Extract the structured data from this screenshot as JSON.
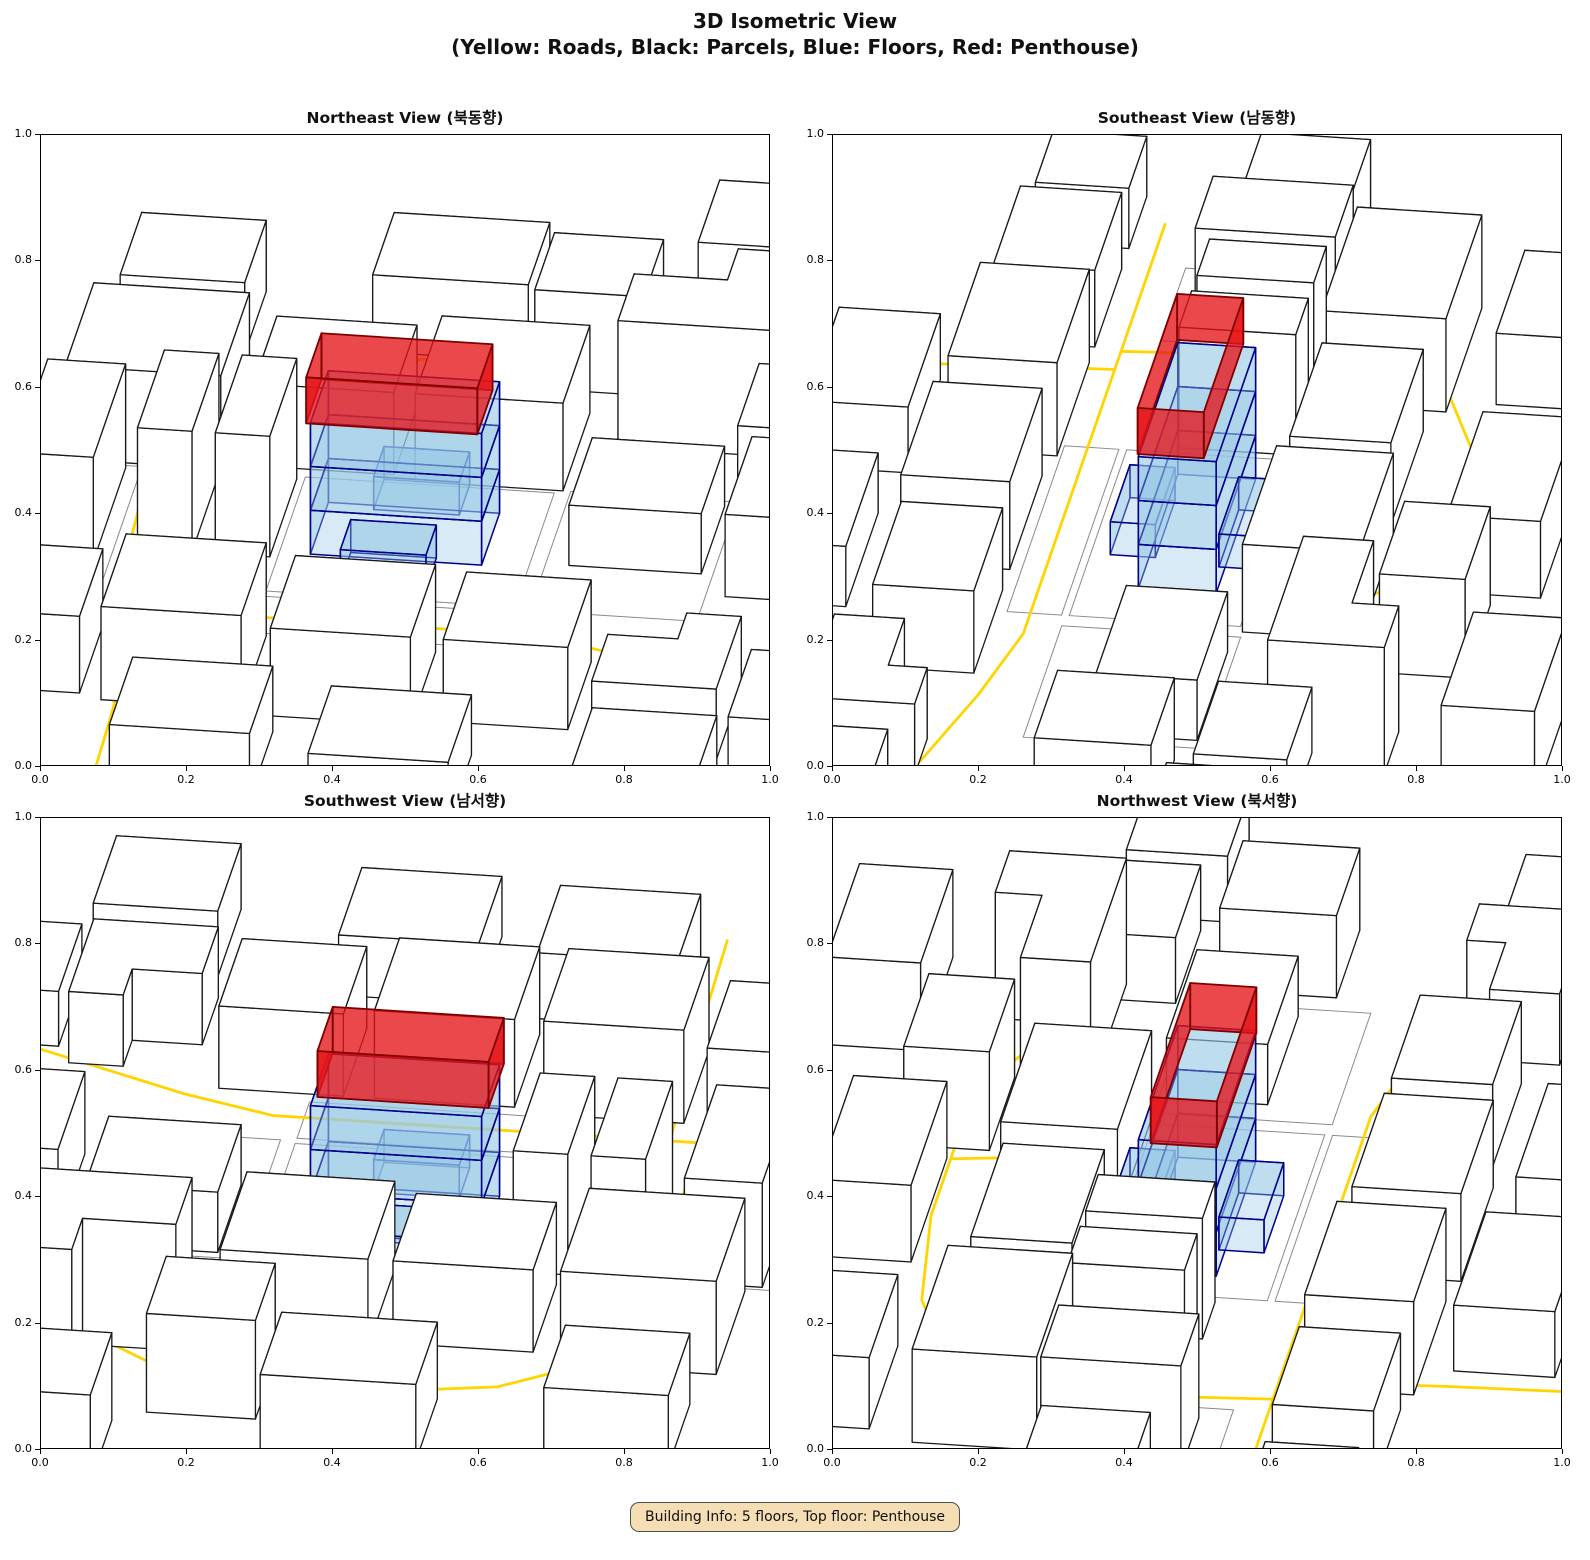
{
  "figure": {
    "title_line1": "3D Isometric View",
    "title_line2": "(Yellow: Roads, Black: Parcels, Blue: Floors, Red: Penthouse)"
  },
  "views": [
    {
      "id": "northeast",
      "title": "Northeast View (북동향)",
      "rotation": 0
    },
    {
      "id": "southeast",
      "title": "Southeast View (남동향)",
      "rotation": 90
    },
    {
      "id": "southwest",
      "title": "Southwest View (남서향)",
      "rotation": 180
    },
    {
      "id": "northwest",
      "title": "Northwest View (북서향)",
      "rotation": 270
    }
  ],
  "axes": {
    "x_ticks": [
      "0.0",
      "0.2",
      "0.4",
      "0.6",
      "0.8",
      "1.0"
    ],
    "y_ticks": [
      "0.0",
      "0.2",
      "0.4",
      "0.6",
      "0.8",
      "1.0"
    ],
    "x_range": [
      0.0,
      1.0
    ],
    "y_range": [
      0.0,
      1.0
    ]
  },
  "colors": {
    "road": "#FFD400",
    "parcel_fill": "#FFFFFF",
    "parcel_edge": "#1a1a1a",
    "floor_fill": "rgba(150,200,230,0.38)",
    "floor_edge": "#00008B",
    "penthouse_fill": "rgba(230,20,25,0.78)",
    "penthouse_edge": "#7f0000",
    "lot_line": "#8a8a8a",
    "info_fill": "#F5DEB3",
    "info_border": "#4d4d4d"
  },
  "info_box": {
    "text": "Building Info: 5 floors, Top floor: Penthouse"
  },
  "building": {
    "floors_count": 5,
    "top_floor": "Penthouse",
    "floors": [
      {
        "x0": -1.1,
        "y0": -0.5,
        "x1": 1.1,
        "y1": 0.5,
        "z0": 0.0,
        "z1": 0.4
      },
      {
        "x0": -1.1,
        "y0": -0.5,
        "x1": 1.1,
        "y1": 0.5,
        "z0": 0.4,
        "z1": 0.8
      },
      {
        "x0": -1.1,
        "y0": -0.5,
        "x1": 1.1,
        "y1": 0.5,
        "z0": 0.8,
        "z1": 1.2
      }
    ],
    "annexes": [
      {
        "x0": -0.6,
        "y0": -1.0,
        "x1": 0.5,
        "y1": -0.42,
        "z0": 0.0,
        "z1": 0.3
      },
      {
        "x0": -0.5,
        "y0": 0.42,
        "x1": 0.6,
        "y1": 1.0,
        "z0": 0.0,
        "z1": 0.3
      }
    ],
    "penthouse": {
      "x0": -1.15,
      "y0": -0.52,
      "x1": 1.05,
      "y1": 0.33,
      "z0": 1.2,
      "z1": 1.62
    }
  },
  "scene": {
    "parcels": [
      {
        "pts": [
          [
            -4.6,
            1.0
          ],
          [
            -2.6,
            1.0
          ],
          [
            -2.6,
            2.6
          ],
          [
            -4.6,
            2.6
          ]
        ],
        "h": 0.85
      },
      {
        "pts": [
          [
            -2.2,
            1.1
          ],
          [
            -0.4,
            1.1
          ],
          [
            -0.4,
            2.4
          ],
          [
            -2.2,
            2.4
          ]
        ],
        "h": 0.75
      },
      {
        "pts": [
          [
            -0.1,
            1.0
          ],
          [
            1.8,
            1.0
          ],
          [
            1.8,
            2.5
          ],
          [
            -0.1,
            2.5
          ]
        ],
        "h": 0.8
      },
      {
        "pts": [
          [
            2.3,
            1.9
          ],
          [
            4.3,
            1.9
          ],
          [
            4.3,
            3.4
          ],
          [
            3.5,
            3.4
          ],
          [
            3.5,
            2.8
          ],
          [
            2.3,
            2.8
          ]
        ],
        "h": 1.15
      },
      {
        "pts": [
          [
            4.0,
            1.2
          ],
          [
            5.4,
            1.2
          ],
          [
            5.4,
            2.4
          ],
          [
            4.0,
            2.4
          ]
        ],
        "h": 0.6
      },
      {
        "pts": [
          [
            1.0,
            2.9
          ],
          [
            2.4,
            2.9
          ],
          [
            2.4,
            4.0
          ],
          [
            1.0,
            4.0
          ]
        ],
        "h": 0.9
      },
      {
        "pts": [
          [
            -1.2,
            3.4
          ],
          [
            0.8,
            3.4
          ],
          [
            0.8,
            4.6
          ],
          [
            -1.2,
            4.6
          ]
        ],
        "h": 0.7
      },
      {
        "pts": [
          [
            -4.8,
            -0.9
          ],
          [
            -3.8,
            -0.9
          ],
          [
            -3.8,
            0.9
          ],
          [
            -4.8,
            0.9
          ]
        ],
        "h": 0.95
      },
      {
        "pts": [
          [
            -3.3,
            -0.6
          ],
          [
            -2.6,
            -0.6
          ],
          [
            -2.6,
            0.9
          ],
          [
            -3.3,
            0.9
          ]
        ],
        "h": 1.1
      },
      {
        "pts": [
          [
            -2.3,
            -0.6
          ],
          [
            -1.6,
            -0.6
          ],
          [
            -1.6,
            0.9
          ],
          [
            -2.3,
            0.9
          ]
        ],
        "h": 1.1
      },
      {
        "pts": [
          [
            2.2,
            -0.4
          ],
          [
            3.9,
            -0.4
          ],
          [
            3.9,
            0.9
          ],
          [
            2.2,
            0.9
          ]
        ],
        "h": 0.55
      },
      {
        "pts": [
          [
            4.3,
            -0.8
          ],
          [
            5.6,
            -0.8
          ],
          [
            5.6,
            0.7
          ],
          [
            4.3,
            0.7
          ]
        ],
        "h": 0.75
      },
      {
        "pts": [
          [
            -4.9,
            -3.4
          ],
          [
            -3.4,
            -3.4
          ],
          [
            -3.4,
            -2.1
          ],
          [
            -4.9,
            -2.1
          ]
        ],
        "h": 0.7
      },
      {
        "pts": [
          [
            -3.1,
            -3.5
          ],
          [
            -1.3,
            -3.5
          ],
          [
            -1.3,
            -2.1
          ],
          [
            -3.1,
            -2.1
          ]
        ],
        "h": 0.85
      },
      {
        "pts": [
          [
            -0.9,
            -3.6
          ],
          [
            0.9,
            -3.6
          ],
          [
            0.9,
            -2.2
          ],
          [
            -0.9,
            -2.2
          ]
        ],
        "h": 0.8
      },
      {
        "pts": [
          [
            1.3,
            -3.5
          ],
          [
            2.9,
            -3.5
          ],
          [
            2.9,
            -2.2
          ],
          [
            1.3,
            -2.2
          ]
        ],
        "h": 0.75
      },
      {
        "pts": [
          [
            3.3,
            -3.9
          ],
          [
            4.9,
            -3.9
          ],
          [
            4.9,
            -2.5
          ],
          [
            4.2,
            -2.5
          ],
          [
            4.2,
            -3.0
          ],
          [
            3.3,
            -3.0
          ]
        ],
        "h": 0.65
      },
      {
        "pts": [
          [
            5.1,
            -4.1
          ],
          [
            6.2,
            -4.1
          ],
          [
            6.2,
            -2.8
          ],
          [
            5.1,
            -2.8
          ]
        ],
        "h": 0.5
      },
      {
        "pts": [
          [
            -2.6,
            -5.2
          ],
          [
            -0.8,
            -5.2
          ],
          [
            -0.8,
            -3.9
          ],
          [
            -2.6,
            -3.9
          ]
        ],
        "h": 0.6
      },
      {
        "pts": [
          [
            0.0,
            -5.4
          ],
          [
            1.8,
            -5.4
          ],
          [
            1.8,
            -4.1
          ],
          [
            0.0,
            -4.1
          ]
        ],
        "h": 0.55
      },
      {
        "pts": [
          [
            2.8,
            4.2
          ],
          [
            4.6,
            4.2
          ],
          [
            4.6,
            5.4
          ],
          [
            2.8,
            5.4
          ]
        ],
        "h": 0.8
      },
      {
        "pts": [
          [
            -4.4,
            3.2
          ],
          [
            -2.8,
            3.2
          ],
          [
            -2.8,
            4.4
          ],
          [
            -4.4,
            4.4
          ]
        ],
        "h": 0.65
      },
      {
        "pts": [
          [
            5.6,
            0.9
          ],
          [
            6.8,
            0.9
          ],
          [
            6.8,
            2.2
          ],
          [
            5.6,
            2.2
          ]
        ],
        "h": 0.6
      },
      {
        "pts": [
          [
            -6.2,
            -0.6
          ],
          [
            -5.2,
            -0.6
          ],
          [
            -5.2,
            0.8
          ],
          [
            -6.2,
            0.8
          ]
        ],
        "h": 0.7
      },
      {
        "pts": [
          [
            -6.3,
            -3.3
          ],
          [
            -5.3,
            -3.3
          ],
          [
            -5.3,
            -2.1
          ],
          [
            -6.3,
            -2.1
          ]
        ],
        "h": 0.55
      },
      {
        "pts": [
          [
            3.4,
            -5.6
          ],
          [
            5.0,
            -5.6
          ],
          [
            5.0,
            -4.3
          ],
          [
            3.4,
            -4.3
          ]
        ],
        "h": 0.6
      }
    ],
    "roads": [
      [
        [
          -5.8,
          -1.75
        ],
        [
          2.1,
          -1.75
        ],
        [
          3.3,
          -2.05
        ],
        [
          6.0,
          -2.95
        ]
      ],
      [
        [
          -3.35,
          -1.75
        ],
        [
          -3.5,
          0.9
        ],
        [
          -3.55,
          1.7
        ]
      ],
      [
        [
          -3.55,
          1.7
        ],
        [
          -3.05,
          2.5
        ],
        [
          -1.9,
          3.1
        ],
        [
          -0.3,
          3.35
        ],
        [
          1.2,
          3.35
        ],
        [
          2.5,
          3.1
        ],
        [
          3.6,
          2.5
        ]
      ],
      [
        [
          0.8,
          3.33
        ],
        [
          0.95,
          2.1
        ]
      ],
      [
        [
          -3.0,
          -1.78
        ],
        [
          -2.9,
          -3.9
        ],
        [
          -2.85,
          -5.6
        ]
      ]
    ],
    "lots": [
      [
        [
          -1.5,
          -1.25
        ],
        [
          1.7,
          -1.25
        ],
        [
          1.7,
          0.95
        ],
        [
          -1.5,
          0.95
        ]
      ],
      [
        [
          1.9,
          -1.3
        ],
        [
          4.05,
          -1.3
        ],
        [
          4.05,
          1.0
        ],
        [
          1.9,
          1.0
        ]
      ],
      [
        [
          -5.0,
          -1.3
        ],
        [
          -3.6,
          -1.3
        ],
        [
          -3.6,
          0.95
        ],
        [
          -5.0,
          0.95
        ]
      ],
      [
        [
          -1.5,
          -2.05
        ],
        [
          1.7,
          -2.05
        ],
        [
          1.7,
          -1.35
        ],
        [
          -1.5,
          -1.35
        ]
      ]
    ]
  }
}
